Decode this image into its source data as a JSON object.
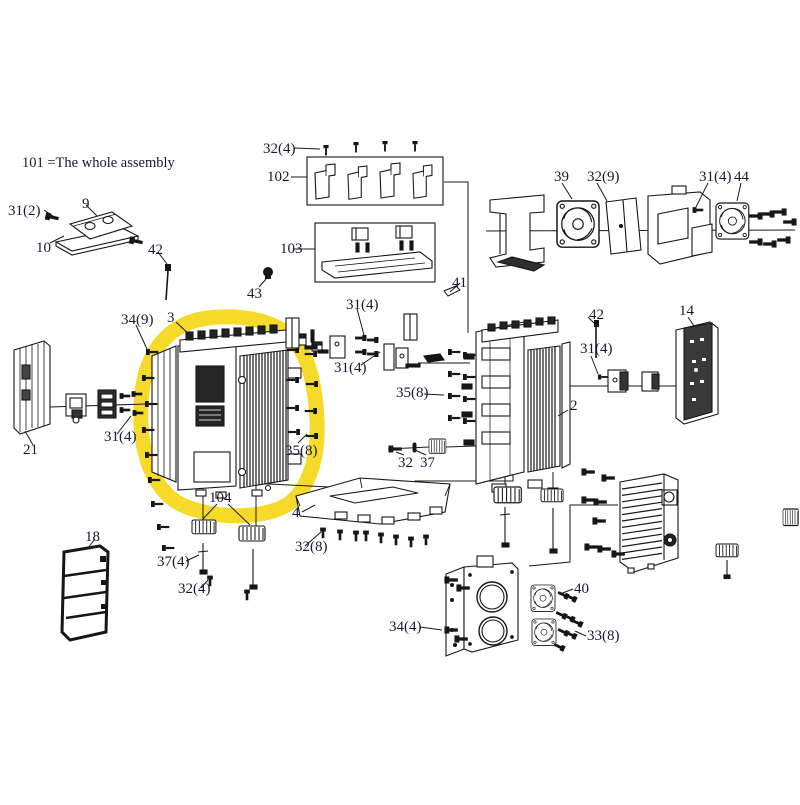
{
  "d": {
    "title": "101 =The whole assembly",
    "highlight_color": "#f4d71a",
    "line_color": "#1a1a1a",
    "labels": [
      {
        "t": "31(2)"
      },
      {
        "t": "9"
      },
      {
        "t": "10"
      },
      {
        "t": "42"
      },
      {
        "t": "43"
      },
      {
        "t": "32(4)"
      },
      {
        "t": "102"
      },
      {
        "t": "103"
      },
      {
        "t": "41"
      },
      {
        "t": "39"
      },
      {
        "t": "32(9)"
      },
      {
        "t": "31(4)"
      },
      {
        "t": "44"
      },
      {
        "t": "34(9)"
      },
      {
        "t": "3"
      },
      {
        "t": "31(4)"
      },
      {
        "t": "31(4)"
      },
      {
        "t": "31(4)"
      },
      {
        "t": "21"
      },
      {
        "t": "35(8)"
      },
      {
        "t": "35(8)"
      },
      {
        "t": "2"
      },
      {
        "t": "42"
      },
      {
        "t": "31(4)"
      },
      {
        "t": "14"
      },
      {
        "t": "32"
      },
      {
        "t": "37"
      },
      {
        "t": "4"
      },
      {
        "t": "32(8)"
      },
      {
        "t": "104"
      },
      {
        "t": "37(4)"
      },
      {
        "t": "32(4)"
      },
      {
        "t": "18"
      },
      {
        "t": "34(4)"
      },
      {
        "t": "40"
      },
      {
        "t": "33(8)"
      }
    ]
  }
}
